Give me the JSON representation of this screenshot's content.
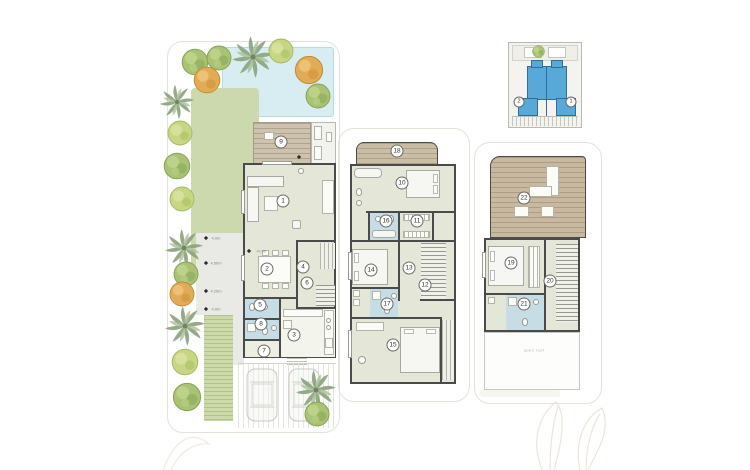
{
  "sheet": {
    "type": "villa-floor-plans",
    "ground": {
      "markers": [
        {
          "num": "9"
        },
        {
          "num": "1"
        },
        {
          "num": "2"
        },
        {
          "num": "4"
        },
        {
          "num": "6"
        },
        {
          "num": "5"
        },
        {
          "num": "8"
        },
        {
          "num": "3"
        },
        {
          "num": "7"
        }
      ],
      "dimensions": [
        "4.0m",
        "4.50m",
        "4.25m",
        "4.0m"
      ],
      "level_label": "+0.00"
    },
    "first": {
      "markers": [
        {
          "num": "18"
        },
        {
          "num": "10"
        },
        {
          "num": "16"
        },
        {
          "num": "11"
        },
        {
          "num": "14"
        },
        {
          "num": "13"
        },
        {
          "num": "12"
        },
        {
          "num": "17"
        },
        {
          "num": "15"
        }
      ]
    },
    "roof": {
      "markers": [
        {
          "num": "22"
        },
        {
          "num": "19"
        },
        {
          "num": "20"
        },
        {
          "num": "21"
        }
      ],
      "open_area_label": "open roof"
    },
    "key_plan": {
      "markers": [
        {
          "num": "2"
        },
        {
          "num": "1"
        }
      ]
    },
    "colors": {
      "unit_highlight": "#58a9d8",
      "bathroom_fill": "#c6dde6",
      "floor_fill": "#e4e7d8",
      "lawn": "#ccd8ad",
      "pool": "#d8edf2",
      "deck": "#cdc2ad",
      "wall": "#4a4a4a"
    }
  }
}
